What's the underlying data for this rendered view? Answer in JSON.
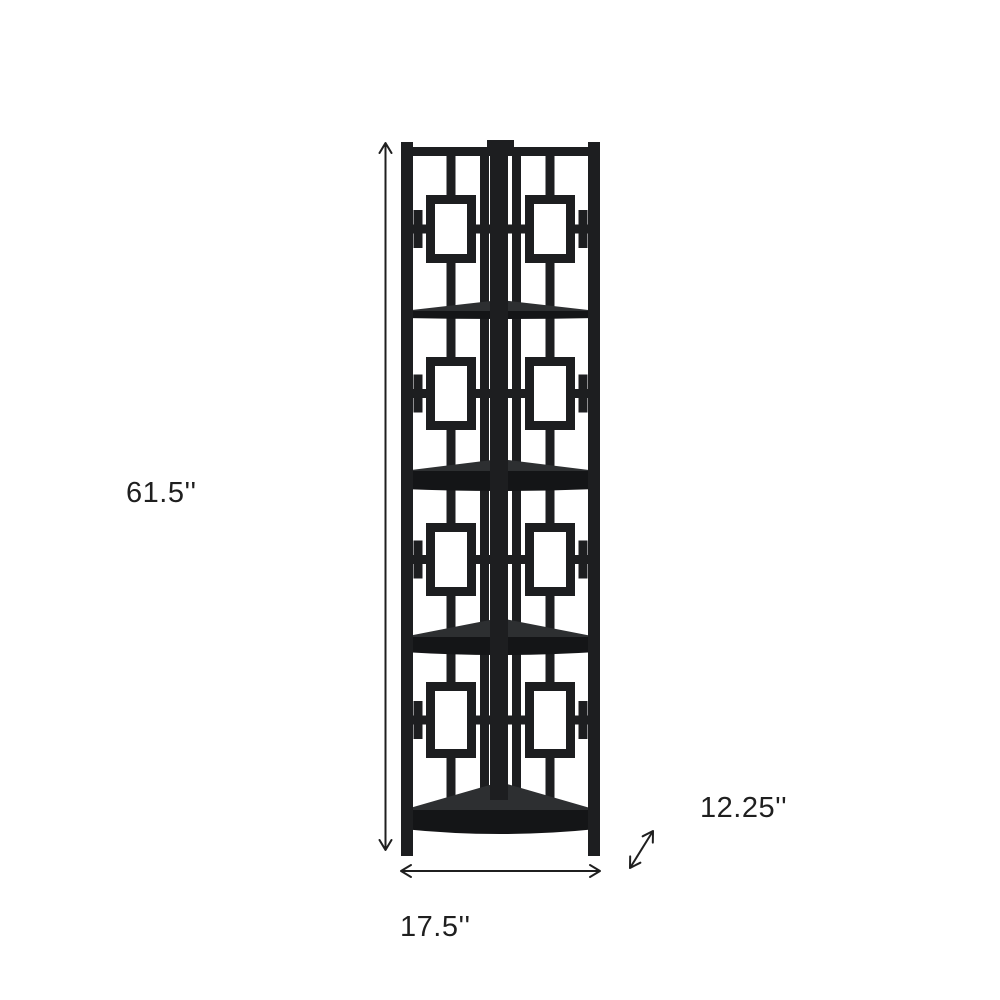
{
  "diagram": {
    "kind": "product-dimension-diagram",
    "product": "4-tier corner bookcase with square lattice motif"
  },
  "dimensions": {
    "height": "61.5''",
    "width": "17.5''",
    "depth": "12.25''"
  },
  "colors": {
    "background": "#ffffff",
    "frame": "#1d1e20",
    "frame_dark": "#141517",
    "shelf_surface": "#2d2f31",
    "annotation": "#1f1f1f"
  }
}
